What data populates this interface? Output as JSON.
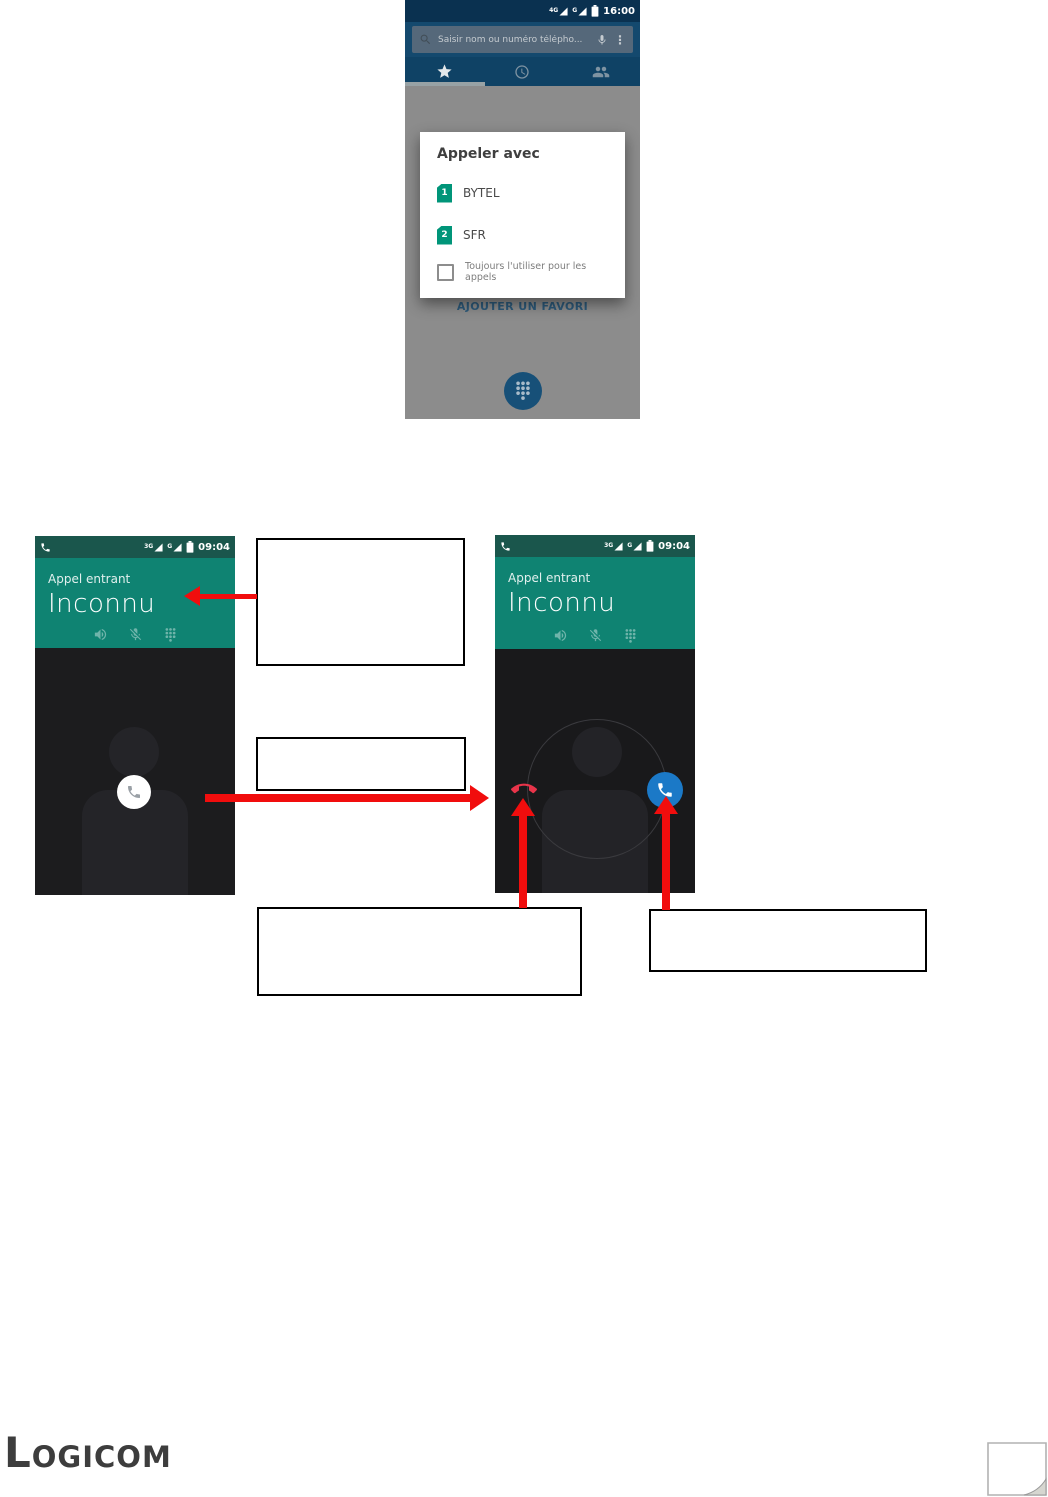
{
  "brand": {
    "logo_text": "Logicom"
  },
  "icons": {
    "overflow": "⋮"
  },
  "dialer": {
    "status": {
      "time": "16:00",
      "net1": "4G",
      "net2": "G"
    },
    "search_placeholder": "Saisir nom ou numéro télépho...",
    "add_favorite": "AJOUTER UN FAVORI",
    "dialog": {
      "title": "Appeler avec",
      "options": [
        {
          "sim": "1",
          "label": "BYTEL"
        },
        {
          "sim": "2",
          "label": "SFR"
        }
      ],
      "always_use": "Toujours l'utiliser pour les appels"
    }
  },
  "incoming_call_left": {
    "status": {
      "time": "09:04",
      "net1": "3G",
      "net2": "G"
    },
    "state_label": "Appel entrant",
    "caller_name": "Inconnu"
  },
  "incoming_call_right": {
    "status": {
      "time": "09:04",
      "net1": "3G",
      "net2": "G"
    },
    "state_label": "Appel entrant",
    "caller_name": "Inconnu"
  },
  "annotations": {
    "box1": "",
    "box2": "",
    "box3": "",
    "box4": ""
  },
  "colors": {
    "dialer_header": "#14496e",
    "call_header_teal": "#0f8372",
    "sim_icon_teal": "#009579",
    "answer_blue": "#1b79c7",
    "decline_red": "#e8344a",
    "arrow_red": "#f10d0d"
  }
}
